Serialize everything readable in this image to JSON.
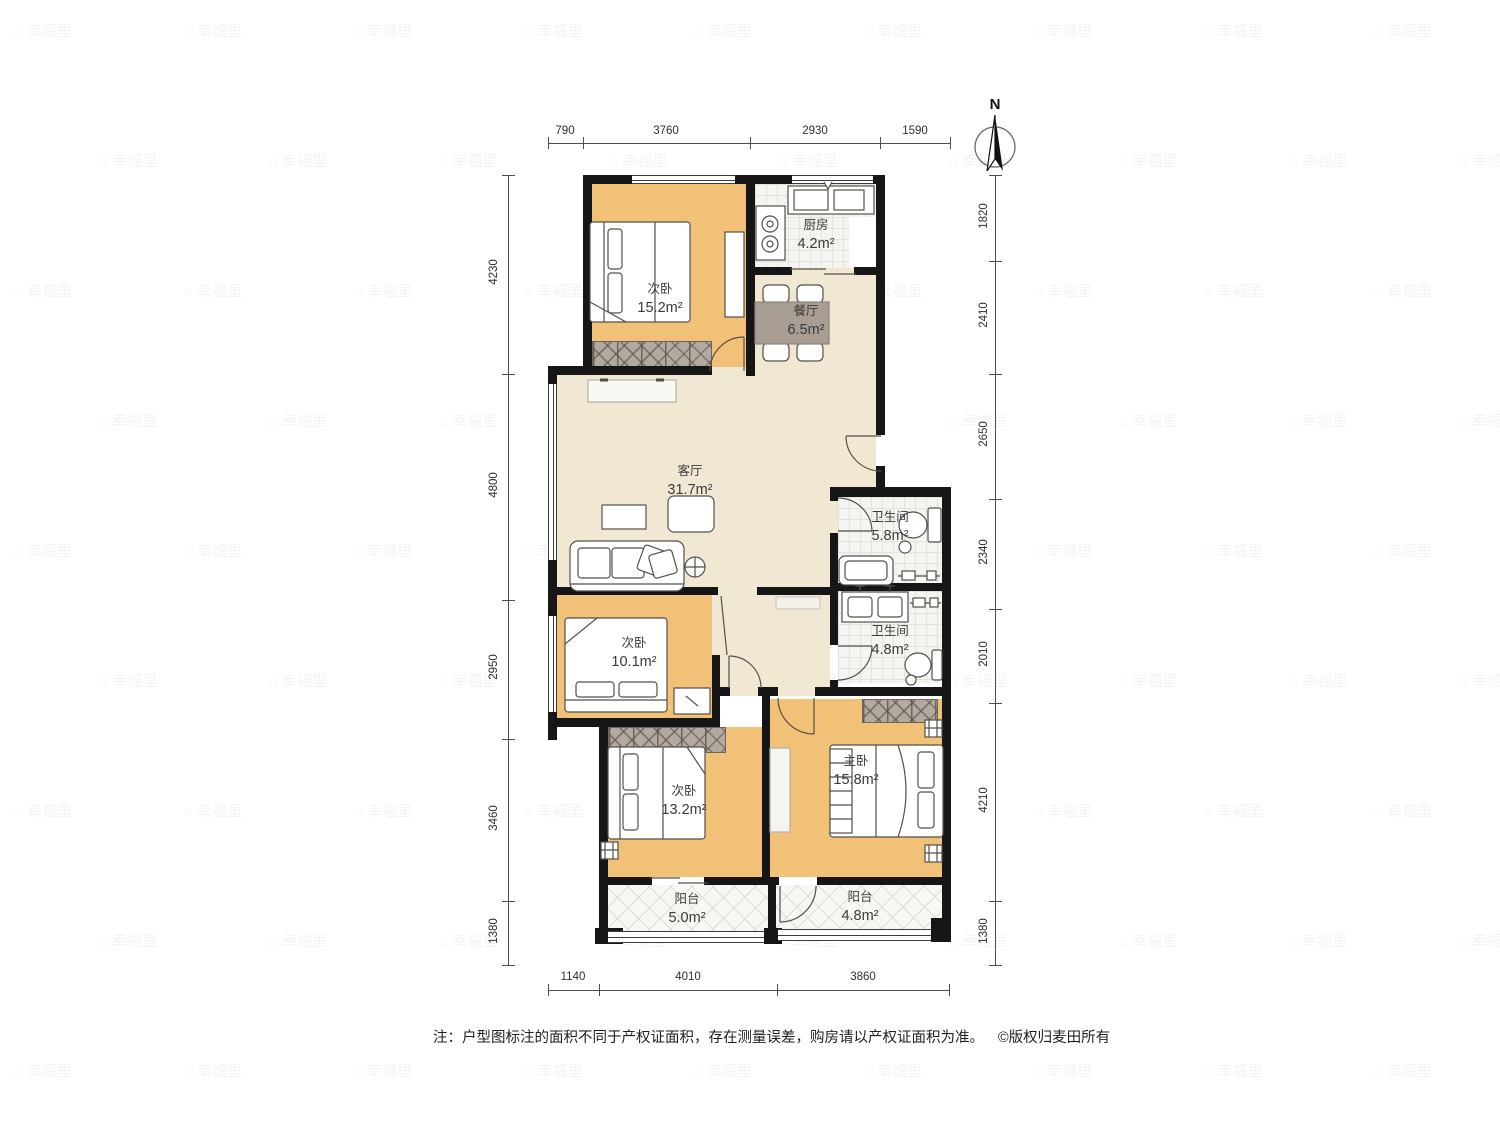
{
  "north_label": "N",
  "rooms": {
    "bedroom_top": {
      "name": "次卧",
      "area": "15.2m²"
    },
    "kitchen": {
      "name": "厨房",
      "area": "4.2m²"
    },
    "dining": {
      "name": "餐厅",
      "area": "6.5m²"
    },
    "living": {
      "name": "客厅",
      "area": "31.7m²"
    },
    "bath_upper": {
      "name": "卫生间",
      "area": "5.8m²"
    },
    "bath_lower": {
      "name": "卫生间",
      "area": "4.8m²"
    },
    "bedroom_mid": {
      "name": "次卧",
      "area": "10.1m²"
    },
    "bedroom_bottom": {
      "name": "次卧",
      "area": "13.2m²"
    },
    "master": {
      "name": "主卧",
      "area": "15.8m²"
    },
    "balcony_left": {
      "name": "阳台",
      "area": "5.0m²"
    },
    "balcony_right": {
      "name": "阳台",
      "area": "4.8m²"
    }
  },
  "dims": {
    "top": [
      "790",
      "3760",
      "2930",
      "1590"
    ],
    "left": [
      "4230",
      "4800",
      "2950",
      "3460",
      "1380"
    ],
    "right": [
      "1820",
      "2410",
      "2650",
      "2340",
      "2010",
      "4210",
      "1380"
    ],
    "bottom": [
      "1140",
      "4010",
      "3860"
    ]
  },
  "footer": {
    "note": "注：户型图标注的面积不同于产权证面积，存在测量误差，购房请以产权证面积为准。",
    "copyright": "©版权归麦田所有"
  },
  "watermark": {
    "glyph": "⌂",
    "text": "幸福里"
  },
  "colors": {
    "wall": "#161616",
    "bedroom_fill": "#f1c177",
    "hall_fill": "#f1e8d4",
    "tile_fill": "#f4f4f1",
    "wardrobe_fill": "#b2a9a0",
    "table_fill": "#a89e94"
  }
}
